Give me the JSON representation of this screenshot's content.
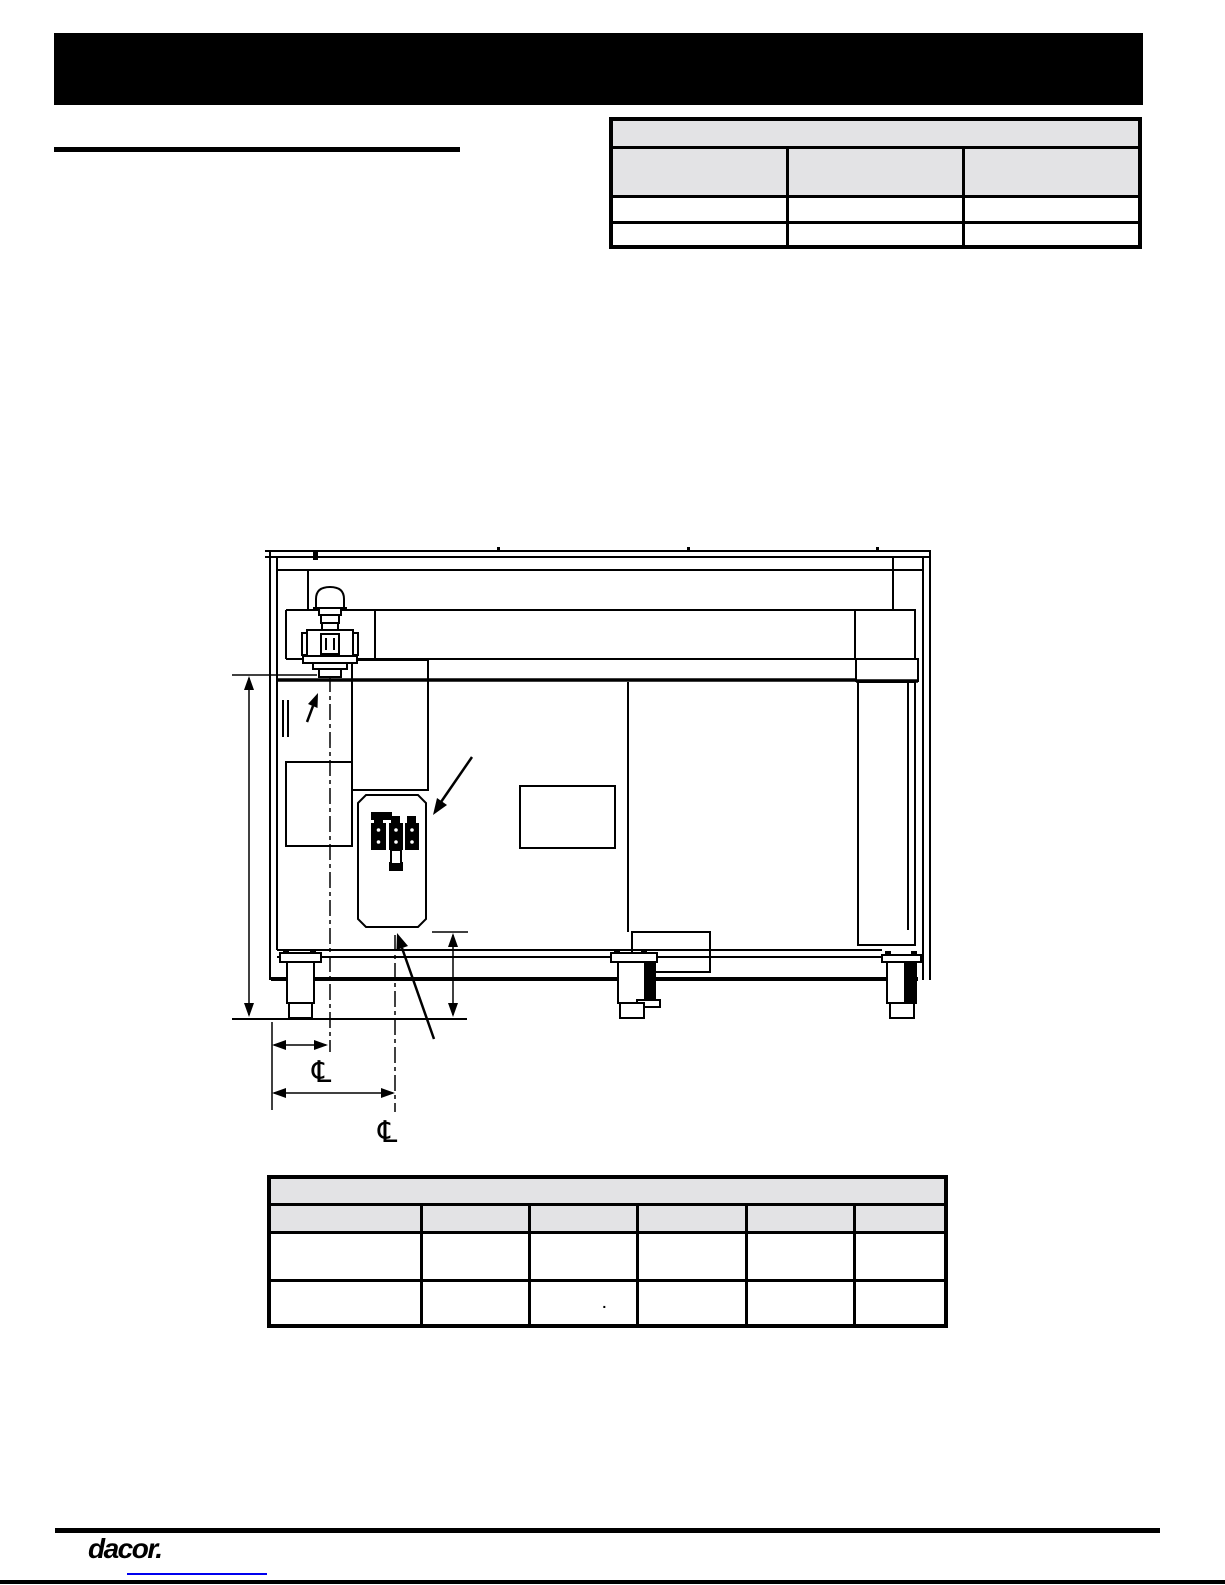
{
  "colors": {
    "ink": "#000000",
    "banner": "#000000",
    "table_header_fill": "#e3e3e5",
    "link_blue": "#0000ee",
    "paper": "#ffffff"
  },
  "header": {
    "banner_text": ""
  },
  "intro": {
    "heading_text": ""
  },
  "upper_table": {
    "title": "",
    "columns": [
      "",
      "",
      ""
    ],
    "rows": [
      [
        "",
        "",
        ""
      ],
      [
        "",
        "",
        ""
      ]
    ]
  },
  "lower_table": {
    "title": "",
    "columns": [
      "",
      "",
      "",
      "",
      "",
      ""
    ],
    "rows": [
      [
        "",
        "",
        "",
        "",
        "",
        ""
      ],
      [
        "",
        "",
        ".",
        "",
        "",
        ""
      ]
    ]
  },
  "diagram": {
    "centerline_symbol": "℄",
    "description": "rear view of range with gas regulator, terminal block, legs and dimensions"
  },
  "footer": {
    "logo": "dacor.",
    "link_text": ""
  }
}
